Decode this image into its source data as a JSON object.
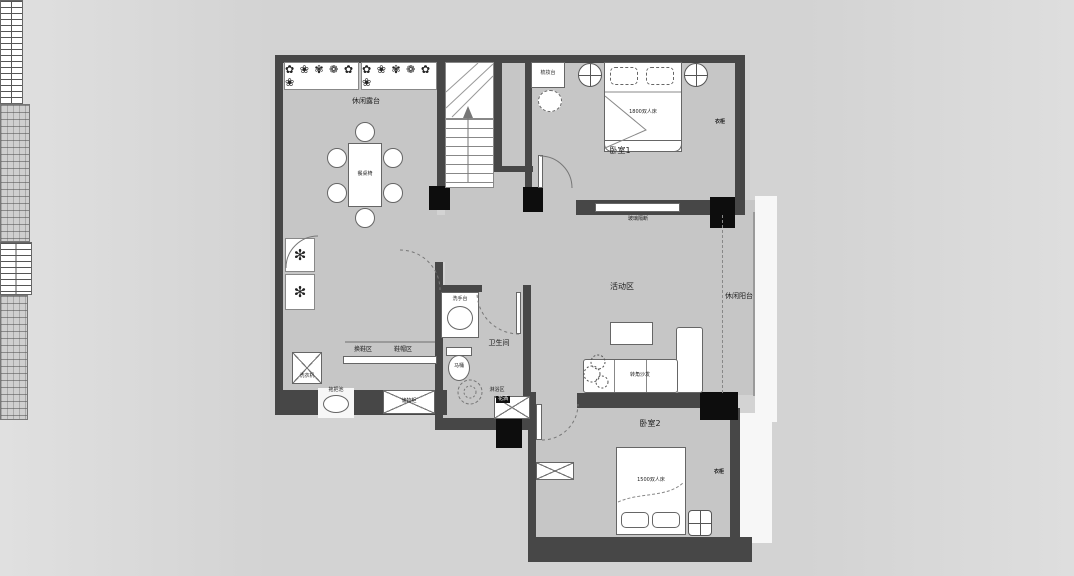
{
  "colors": {
    "background": "#d7d7d7",
    "floor": "#c6c6c6",
    "wall": "#474747",
    "column": "#0d0d0d",
    "furniture": "#ffffff",
    "line": "#666666"
  },
  "icons": {
    "flower_band": "✿ ❀ ✾ ❁ ✿ ❀",
    "plant": "✻"
  },
  "rooms": {
    "terrace": {
      "name": "休闲露台",
      "dining_table": "餐桌椅"
    },
    "bedroom1": {
      "name": "卧室1",
      "bed": "1800双人床",
      "dresser": "梳妆台",
      "wardrobe": "衣柜",
      "window": "玻璃隔断"
    },
    "activity": {
      "name": "活动区",
      "sofa": "转角沙发"
    },
    "balcony": {
      "name": "休闲阳台"
    },
    "entry": {
      "shoe_change": "换鞋区",
      "shoe_hat": "鞋帽区",
      "washer": "洗衣机",
      "mop_pool": "拖把池",
      "cabinet": "储物柜"
    },
    "bathroom": {
      "name": "卫生间",
      "basin": "洗手台",
      "toilet": "马桶",
      "shower_zone": "淋浴区",
      "shower_tag": "花洒"
    },
    "bedroom2": {
      "name": "卧室2",
      "bed": "1500双人床",
      "wardrobe": "衣柜"
    }
  }
}
